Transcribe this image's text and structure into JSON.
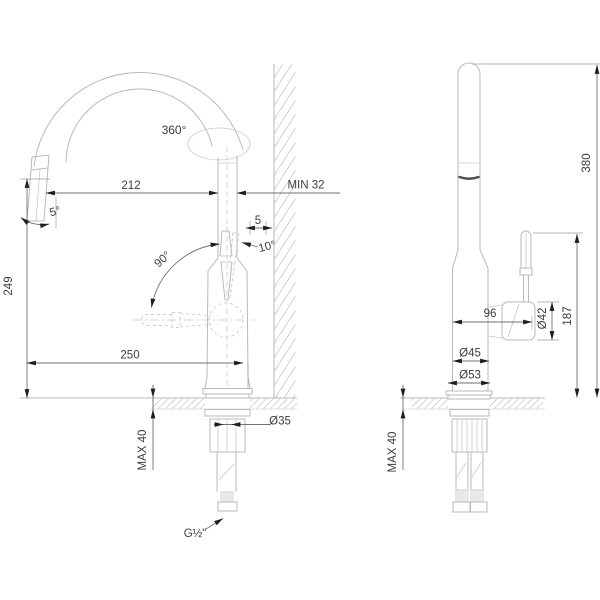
{
  "title": "Kitchen faucet dimensional drawing, front and side views",
  "views": {
    "front": {
      "labels": {
        "swivel_angle": "360°",
        "spout_reach": "212",
        "wall_min": "MIN 32",
        "spout_tilt": "5°",
        "wall_gap": "5",
        "handle_tilt": "10°",
        "handle_swing": "90°",
        "spout_height": "249",
        "overall_depth": "250",
        "deck_thickness_max": "MAX 40",
        "shank_diameter": "Ø35",
        "thread_size": "G½\""
      }
    },
    "side": {
      "labels": {
        "overall_height": "380",
        "handle_top_height": "187",
        "body_depth": "96",
        "handle_diameter": "Ø42",
        "body_diameter": "Ø45",
        "base_diameter": "Ø53",
        "deck_thickness_max": "MAX 40"
      }
    }
  },
  "colors": {
    "background": "#ffffff",
    "faucet_outline": "#b6babd",
    "dimension_line": "#717171",
    "dimension_text": "#3d3d3d",
    "arrow": "#1e1e1e",
    "hatch": "#c9cdd0",
    "shadow_band": "#4f4f4f"
  }
}
